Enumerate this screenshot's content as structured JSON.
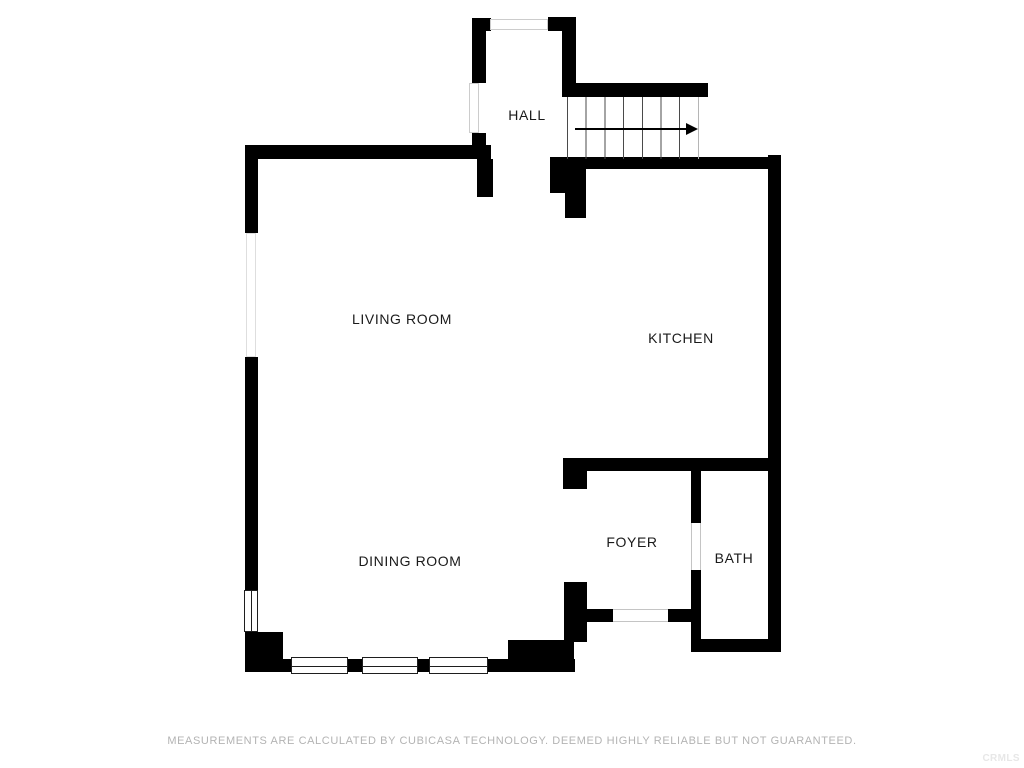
{
  "rooms": {
    "hall": "HALL",
    "living_room": "LIVING ROOM",
    "kitchen": "KITCHEN",
    "dining_room": "DINING ROOM",
    "foyer": "FOYER",
    "bath": "BATH"
  },
  "stairs": {
    "tread_count": 7,
    "direction": "right"
  },
  "footer": {
    "disclaimer": "MEASUREMENTS ARE CALCULATED BY CUBICASA TECHNOLOGY. DEEMED HIGHLY RELIABLE BUT NOT GUARANTEED.",
    "watermark": "CRMLS"
  },
  "colors": {
    "background": "#ffffff",
    "wall": "#000000",
    "room_label_text": "#1a1a1a",
    "disclaimer_text": "#b3b3b3",
    "watermark_text": "#e7e7e7",
    "window_symbol_light": "#cccccc",
    "window_symbol_dark": "#1e1e1e"
  }
}
